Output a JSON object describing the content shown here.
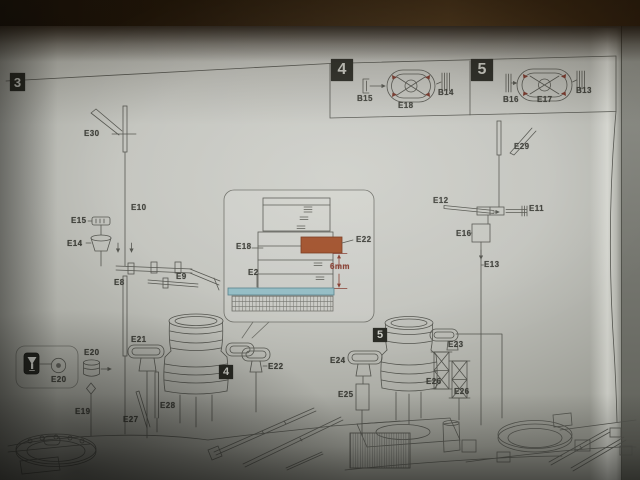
{
  "steps": {
    "main": "3",
    "inset_a": "4",
    "inset_b": "5"
  },
  "step_markers": [
    {
      "label": "3",
      "x": 10,
      "y": 73,
      "w": 15,
      "h": 18,
      "fs": 13
    },
    {
      "label": "4",
      "x": 331,
      "y": 59,
      "w": 22,
      "h": 22,
      "fs": 16
    },
    {
      "label": "5",
      "x": 471,
      "y": 59,
      "w": 22,
      "h": 22,
      "fs": 16
    },
    {
      "label": "4",
      "x": 219,
      "y": 365,
      "w": 14,
      "h": 14,
      "fs": 11
    },
    {
      "label": "5",
      "x": 373,
      "y": 328,
      "w": 14,
      "h": 14,
      "fs": 11
    }
  ],
  "dimension_note": "6mm",
  "part_labels": [
    {
      "id": "E30",
      "text": "E30",
      "x": 84,
      "y": 130
    },
    {
      "id": "E10",
      "text": "E10",
      "x": 131,
      "y": 204
    },
    {
      "id": "E15",
      "text": "E15",
      "x": 71,
      "y": 217
    },
    {
      "id": "E14",
      "text": "E14",
      "x": 67,
      "y": 240
    },
    {
      "id": "E8",
      "text": "E8",
      "x": 114,
      "y": 279
    },
    {
      "id": "E9",
      "text": "E9",
      "x": 176,
      "y": 273
    },
    {
      "id": "B15",
      "text": "B15",
      "x": 357,
      "y": 95
    },
    {
      "id": "E18-inset",
      "text": "E18",
      "x": 398,
      "y": 102
    },
    {
      "id": "B14",
      "text": "B14",
      "x": 438,
      "y": 89
    },
    {
      "id": "B16",
      "text": "B16",
      "x": 503,
      "y": 96
    },
    {
      "id": "E17",
      "text": "E17",
      "x": 537,
      "y": 96
    },
    {
      "id": "B13",
      "text": "B13",
      "x": 576,
      "y": 87
    },
    {
      "id": "E29",
      "text": "E29",
      "x": 514,
      "y": 143
    },
    {
      "id": "E12",
      "text": "E12",
      "x": 433,
      "y": 197
    },
    {
      "id": "E11",
      "text": "E11",
      "x": 529,
      "y": 205
    },
    {
      "id": "E16",
      "text": "E16",
      "x": 456,
      "y": 230
    },
    {
      "id": "E13",
      "text": "E13",
      "x": 484,
      "y": 261
    },
    {
      "id": "E18-detail",
      "text": "E18",
      "x": 236,
      "y": 243
    },
    {
      "id": "E22-detail",
      "text": "E22",
      "x": 356,
      "y": 236
    },
    {
      "id": "E2",
      "text": "E2",
      "x": 248,
      "y": 269
    },
    {
      "id": "6mm",
      "text": "6mm",
      "x": 330,
      "y": 263,
      "accent": true
    },
    {
      "id": "E20-top",
      "text": "E20",
      "x": 51,
      "y": 376
    },
    {
      "id": "E20-part",
      "text": "E20",
      "x": 84,
      "y": 349
    },
    {
      "id": "E19",
      "text": "E19",
      "x": 75,
      "y": 408
    },
    {
      "id": "E21",
      "text": "E21",
      "x": 131,
      "y": 336
    },
    {
      "id": "E27",
      "text": "E27",
      "x": 123,
      "y": 416
    },
    {
      "id": "E28",
      "text": "E28",
      "x": 160,
      "y": 402
    },
    {
      "id": "E22-tub",
      "text": "E22",
      "x": 268,
      "y": 363
    },
    {
      "id": "E24",
      "text": "E24",
      "x": 330,
      "y": 357
    },
    {
      "id": "E23",
      "text": "E23",
      "x": 448,
      "y": 341
    },
    {
      "id": "E25",
      "text": "E25",
      "x": 338,
      "y": 391
    },
    {
      "id": "E26-left",
      "text": "E26",
      "x": 426,
      "y": 378
    },
    {
      "id": "E26-right",
      "text": "E26",
      "x": 454,
      "y": 388
    }
  ],
  "colors": {
    "ink": "#50514a",
    "label_ink": "#3b3c35",
    "paper": "#c6c7c0",
    "wood": "#3d2a12",
    "step_box": "#23241d",
    "highlight_part_orange": "#a8491d",
    "deck_strip_blue": "#8fc0c9",
    "dimension_red": "#8b3526",
    "corner_mark_red": "#7d3022"
  }
}
